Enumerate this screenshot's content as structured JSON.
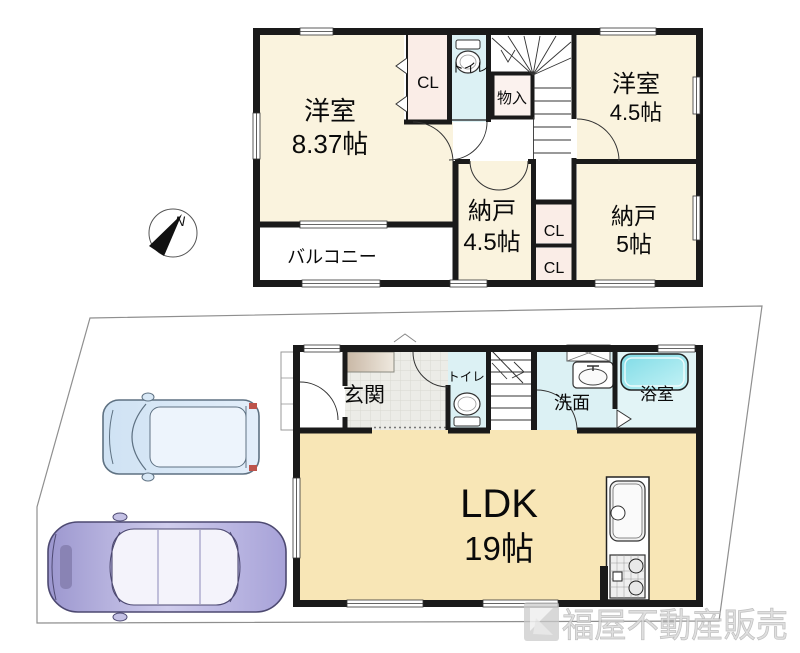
{
  "compass": {
    "north_label": "N"
  },
  "logo": {
    "company_name": "福屋不動産販売"
  },
  "floor2": {
    "western_room_main": {
      "name": "洋室",
      "size": "8.37帖"
    },
    "closet_main": {
      "label": "CL"
    },
    "toilet": {
      "label": "トイレ"
    },
    "storage_inset": {
      "label": "物入"
    },
    "western_room_45": {
      "name": "洋室",
      "size": "4.5帖"
    },
    "storage_room_45": {
      "name": "納戸",
      "size": "4.5帖"
    },
    "closet_upper": {
      "label": "CL"
    },
    "closet_lower": {
      "label": "CL"
    },
    "storage_room_5": {
      "name": "納戸",
      "size": "5帖"
    },
    "balcony": {
      "label": "バルコニー"
    }
  },
  "floor1": {
    "entrance": {
      "label": "玄関"
    },
    "toilet": {
      "label": "トイレ"
    },
    "washroom": {
      "label": "洗面"
    },
    "bathroom": {
      "label": "浴室"
    },
    "ldk": {
      "name": "LDK",
      "size": "19帖"
    }
  },
  "colors": {
    "wall": "#1a1a1a",
    "room_cream": "#faf3de",
    "ldk_cream": "#f8e6b6",
    "wet_area_blue": "#dcf1f4",
    "closet_pink": "#faede7",
    "bathtub_cyan": "#8adfe9",
    "car_wagon_blue": "#d8e8f6",
    "car_sedan_purple": "#aba6d9",
    "logo_watermark_gray": "#d6d6d6"
  }
}
